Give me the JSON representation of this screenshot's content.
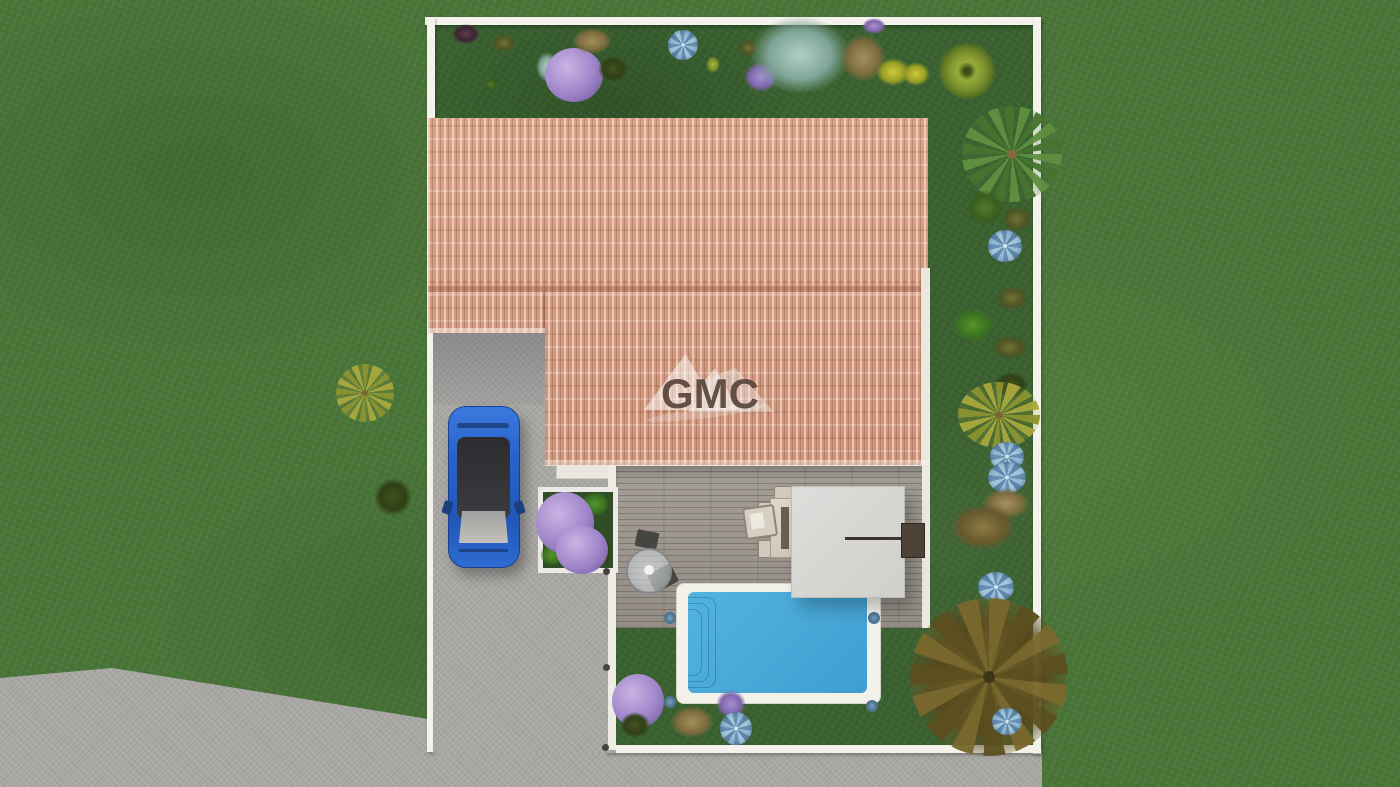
{
  "watermark": {
    "text": "GMC"
  },
  "scene": {
    "description": "Top-down 3D architectural rendering of a fenced house plot with terracotta roof, wooden deck, pergola, swimming pool, blue car on driveway and landscaped garden",
    "objects": [
      "outer lawn",
      "white property fence",
      "terracotta tile roof",
      "garage roof wing",
      "gravel driveway",
      "blue hatchback car",
      "wooden deck",
      "white pergola",
      "outdoor dining table with chairs",
      "lounge chair",
      "bistro table with two chairs",
      "outdoor kitchen unit",
      "swimming pool with roman steps",
      "flower planter box",
      "palm tree",
      "agave plants",
      "lilac shrubs",
      "autumn tree",
      "street pavement"
    ],
    "colors": {
      "grass_outer": "#4a7539",
      "grass_yard": "#3a6130",
      "roof_tile": "#d29b82",
      "fence": "#f3f2ec",
      "driveway": "#a9a7a4",
      "deck": "#9b968f",
      "pool_water": "#45a8d8",
      "pool_coping": "#f2f1ea",
      "car_body": "#2a6bd4",
      "pergola": "#d8d8d4"
    }
  }
}
